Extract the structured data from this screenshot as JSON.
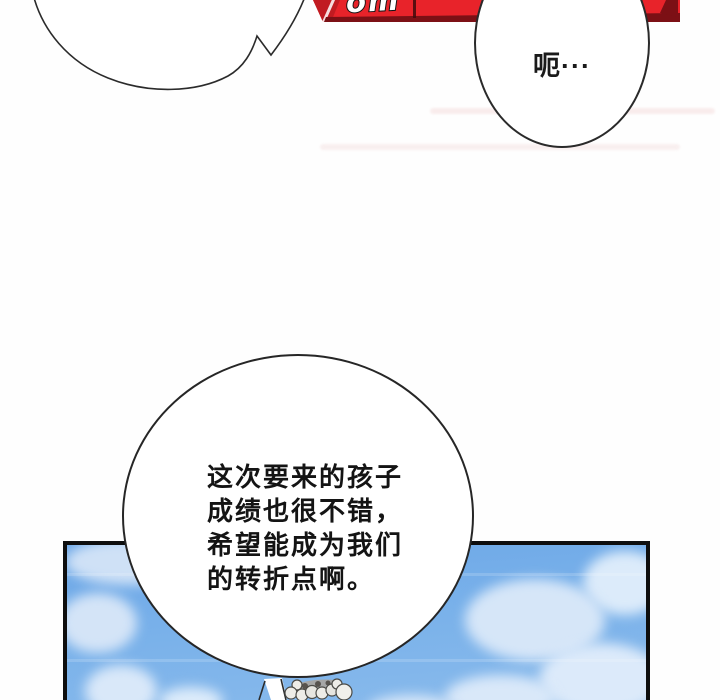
{
  "comic": {
    "bubble_top_left": {
      "text": ""
    },
    "bubble_top_right": {
      "text": "呃···"
    },
    "bubble_main": {
      "line1": "这次要来的孩子",
      "line2": "成绩也很不错，",
      "line3": "希望能成为我们",
      "line4": "的转折点啊。"
    },
    "banner": {
      "partial_text": "om",
      "red": "#e8232a",
      "dark_red": "#7c1015"
    },
    "sky_panel": {
      "border": "#0e0e0e",
      "sky_top": "#6ca7e7",
      "sky_bottom": "#8abbec",
      "cloud": "#d9e8f9"
    }
  }
}
